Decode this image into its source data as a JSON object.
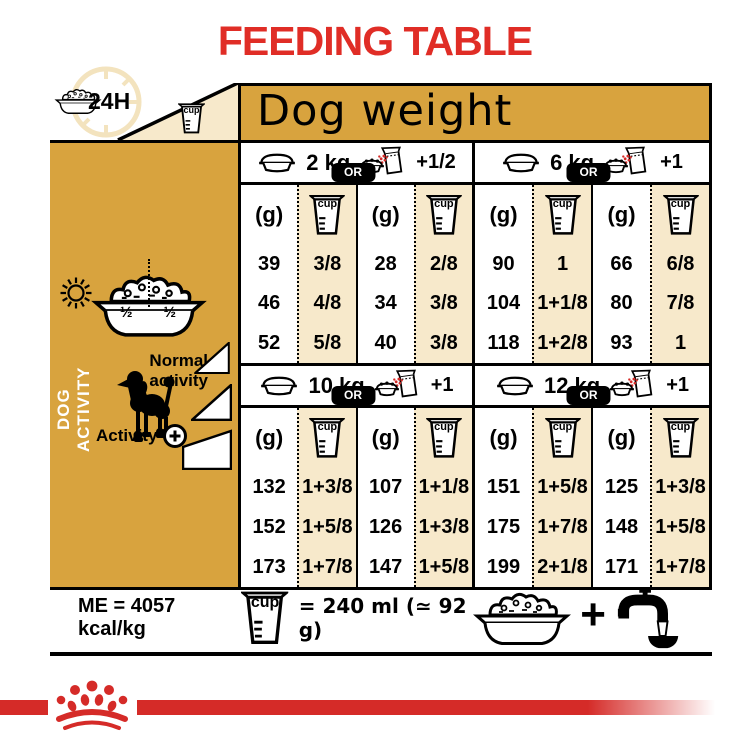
{
  "title": "FEEDING TABLE",
  "colors": {
    "gold": "#D8A33E",
    "cream": "#F7E9CB",
    "red": "#E02D26",
    "band_red": "#D52B28"
  },
  "corner": {
    "hours_label": "24H",
    "cup_label": "cup"
  },
  "dog_weight_label": "Dog weight",
  "sidebar": {
    "vertical_label": "DOG ACTIVITY",
    "half_left": "½",
    "half_right": "½",
    "normal_activity_label": "Normal activity",
    "activity_label": "Activity"
  },
  "quadrants": [
    {
      "weight": "2 kg",
      "or_label": "OR",
      "extra_label": "+1/2",
      "gram_unit": "(g)",
      "cup_label": "cup",
      "left_g": [
        "39",
        "46",
        "52"
      ],
      "left_cup": [
        "3/8",
        "4/8",
        "5/8"
      ],
      "right_g": [
        "28",
        "34",
        "40"
      ],
      "right_cup": [
        "2/8",
        "3/8",
        "3/8"
      ]
    },
    {
      "weight": "6 kg",
      "or_label": "OR",
      "extra_label": "+1",
      "gram_unit": "(g)",
      "cup_label": "cup",
      "left_g": [
        "90",
        "104",
        "118"
      ],
      "left_cup": [
        "1",
        "1+1/8",
        "1+2/8"
      ],
      "right_g": [
        "66",
        "80",
        "93"
      ],
      "right_cup": [
        "6/8",
        "7/8",
        "1"
      ]
    },
    {
      "weight": "10 kg",
      "or_label": "OR",
      "extra_label": "+1",
      "gram_unit": "(g)",
      "cup_label": "cup",
      "left_g": [
        "132",
        "152",
        "173"
      ],
      "left_cup": [
        "1+3/8",
        "1+5/8",
        "1+7/8"
      ],
      "right_g": [
        "107",
        "126",
        "147"
      ],
      "right_cup": [
        "1+1/8",
        "1+3/8",
        "1+5/8"
      ]
    },
    {
      "weight": "12 kg",
      "or_label": "OR",
      "extra_label": "+1",
      "gram_unit": "(g)",
      "cup_label": "cup",
      "left_g": [
        "151",
        "175",
        "199"
      ],
      "left_cup": [
        "1+5/8",
        "1+7/8",
        "2+1/8"
      ],
      "right_g": [
        "125",
        "148",
        "171"
      ],
      "right_cup": [
        "1+3/8",
        "1+5/8",
        "1+7/8"
      ]
    }
  ],
  "footer": {
    "me_label": "ME = 4057 kcal/kg",
    "cup_label": "cup",
    "equivalence_label": "= 240 ml (≃ 92 g)",
    "plus_label": "+"
  },
  "icons": [
    "kibble-bowl",
    "measuring-cup",
    "clock-24h",
    "feeding-bowl",
    "food-pouch",
    "sun",
    "moon",
    "half-half-bowl",
    "poodle-silhouette",
    "activity-ramp",
    "plus-circle",
    "water-tap",
    "crown-logo"
  ]
}
